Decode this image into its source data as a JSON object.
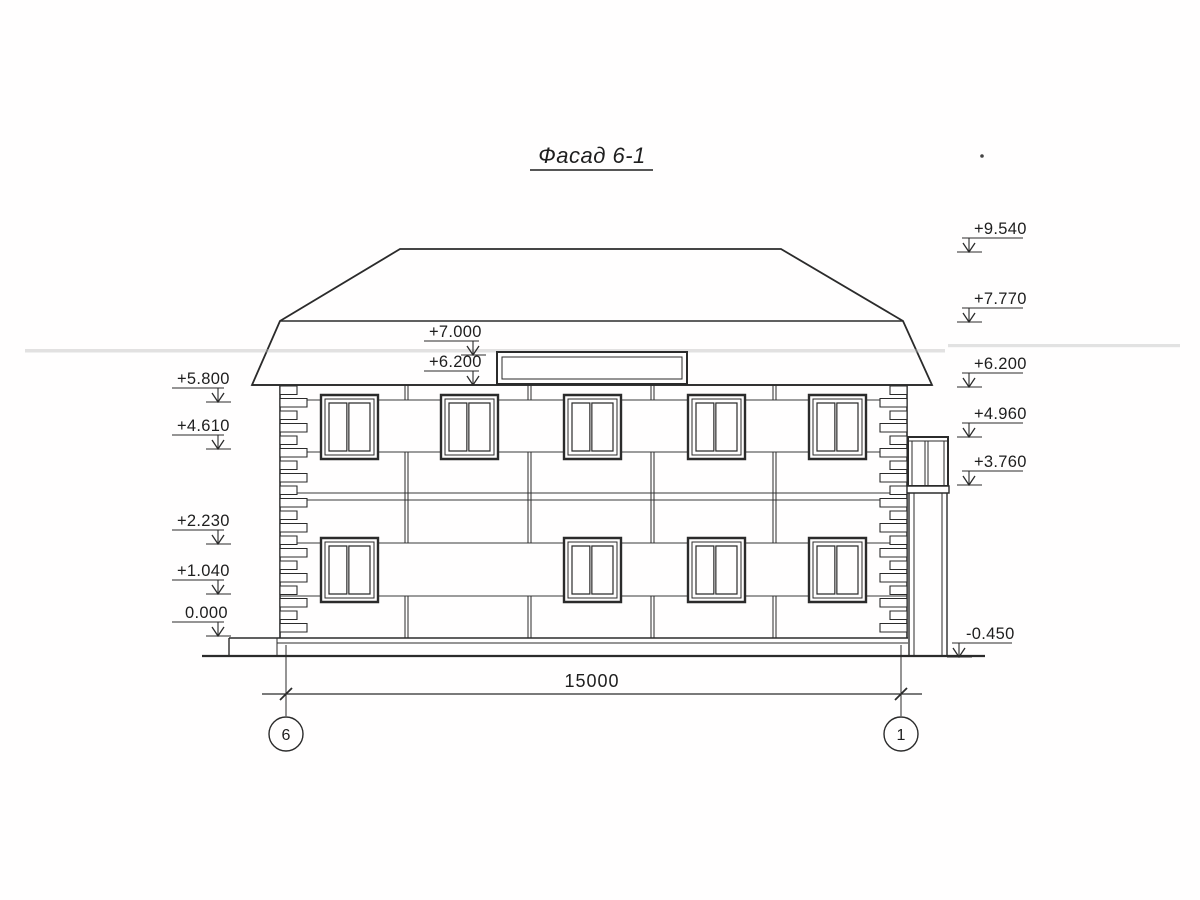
{
  "title": "Фасад 6-1",
  "marks": {
    "right": [
      {
        "value": "+9.540"
      },
      {
        "value": "+7.770"
      },
      {
        "value": "+6.200"
      },
      {
        "value": "+4.960"
      },
      {
        "value": "+3.760"
      },
      {
        "value": "-0.450"
      }
    ],
    "left": [
      {
        "value": "+5.800"
      },
      {
        "value": "+4.610"
      },
      {
        "value": "+2.230"
      },
      {
        "value": "+1.040"
      },
      {
        "value": "0.000"
      }
    ],
    "middle": [
      {
        "value": "+7.000"
      },
      {
        "value": "+6.200"
      }
    ]
  },
  "dimension": {
    "value": "15000"
  },
  "axis_bubbles": [
    {
      "label": "6"
    },
    {
      "label": "1"
    }
  ],
  "colors": {
    "line": "#2b2b2b",
    "paper": "#fffefe"
  }
}
